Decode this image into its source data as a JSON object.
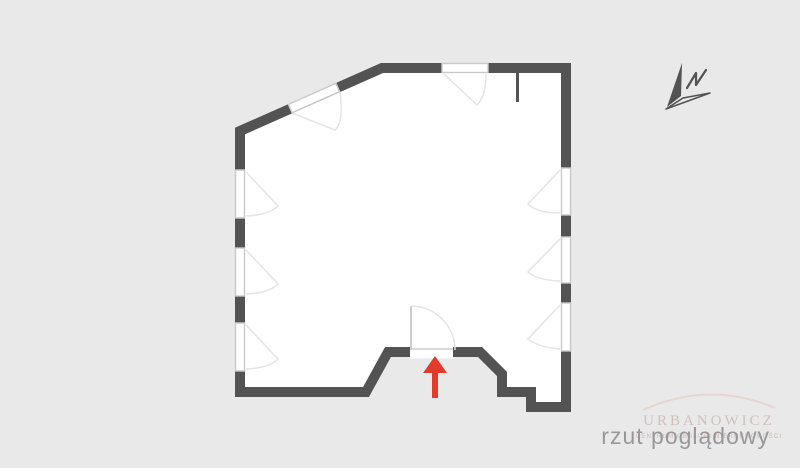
{
  "caption": {
    "text": "rzut poglądowy"
  },
  "watermark": {
    "name": "URBANOWICZ",
    "subtext": "CENTRUM OBSŁUGI NIERUCHOMOŚCI"
  },
  "compass": {
    "label": "N",
    "icon": "north-arrow-icon"
  },
  "icons": {
    "north_arrow": "north-arrow-icon",
    "entrance_arrow": "entrance-arrow-icon"
  },
  "colors": {
    "background": "#e9e9e9",
    "wall": "#535353",
    "room": "#ffffff",
    "window_outline": "#c9c9c9",
    "swing_arc": "#e4e4e4",
    "door_leaf": "#cccccc",
    "threshold": "#d9d9d9",
    "arrow_red": "#e03b2b",
    "caption_text": "#98989a",
    "watermark_tint": "#c6b3b0"
  },
  "floorplan": {
    "type": "overview plan (rzut poglądowy)",
    "windows": {
      "left_wall": 3,
      "right_wall": 3,
      "top_wall": 1,
      "diagonal_wall": 1
    },
    "door": {
      "location": "bottom-center",
      "swing": "inward"
    },
    "interior_partition_stub": "top-right",
    "entrance_marker": "red arrow pointing up at bottom door"
  }
}
